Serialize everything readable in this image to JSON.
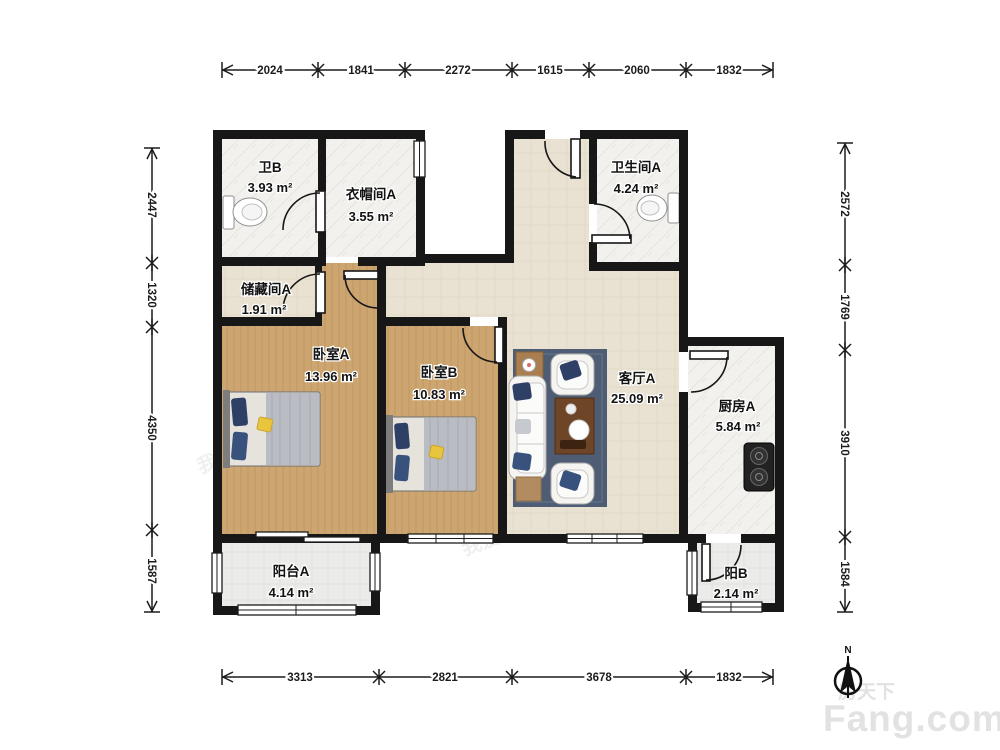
{
  "rooms": [
    {
      "name": "卫B",
      "area": "3.93 m²"
    },
    {
      "name": "衣帽间A",
      "area": "3.55 m²"
    },
    {
      "name": "卫生间A",
      "area": "4.24 m²"
    },
    {
      "name": "储藏间A",
      "area": "1.91 m²"
    },
    {
      "name": "卧室A",
      "area": "13.96 m²"
    },
    {
      "name": "卧室B",
      "area": "10.83 m²"
    },
    {
      "name": "客厅A",
      "area": "25.09 m²"
    },
    {
      "name": "厨房A",
      "area": "5.84 m²"
    },
    {
      "name": "阳台A",
      "area": "4.14 m²"
    },
    {
      "name": "阳B",
      "area": "2.14 m²"
    }
  ],
  "dimensions": {
    "top": [
      "2024",
      "1841",
      "2272",
      "1615",
      "2060",
      "1832"
    ],
    "bottom": [
      "3313",
      "2821",
      "3678",
      "1832"
    ],
    "left": [
      "2447",
      "1320",
      "4350",
      "1587"
    ],
    "right": [
      "2572",
      "1769",
      "3910",
      "1584"
    ]
  },
  "compass": {
    "north_label": "N"
  },
  "watermark": {
    "brand_cn": "房天下",
    "brand_en": "Fang.com",
    "agency": "我爱我家"
  },
  "colors": {
    "wall": "#171717",
    "wood_floor": "#cda571",
    "tile_beige": "#e9e2d2",
    "tile_white": "#f2f1ee",
    "balcony_tile": "#ebebe9",
    "rug": "#4e5d73",
    "pillow_navy": "#2f4066",
    "pillow_yellow": "#e9c53e",
    "logo_gray": "#e2e2e2"
  }
}
